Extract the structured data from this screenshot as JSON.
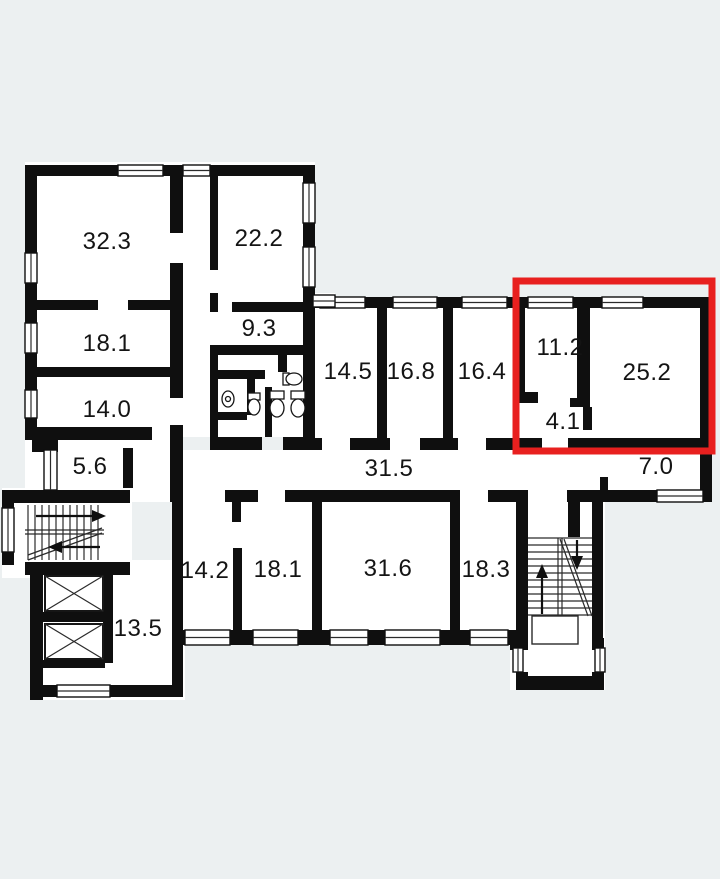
{
  "floorplan": {
    "type": "building-floor-plan",
    "background_color": "#ecf0f1",
    "wall_color": "#0f0f0f",
    "highlight_color": "#e8201f",
    "highlighted_room_areas": [
      "11.2",
      "4.1",
      "25.2"
    ],
    "rooms": [
      {
        "id": "room-32-3",
        "label": "32.3"
      },
      {
        "id": "room-22-2",
        "label": "22.2"
      },
      {
        "id": "room-18-1-upper",
        "label": "18.1"
      },
      {
        "id": "room-9-3",
        "label": "9.3"
      },
      {
        "id": "room-14-0",
        "label": "14.0"
      },
      {
        "id": "room-14-5",
        "label": "14.5"
      },
      {
        "id": "room-16-8",
        "label": "16.8"
      },
      {
        "id": "room-16-4",
        "label": "16.4"
      },
      {
        "id": "room-11-2",
        "label": "11.2"
      },
      {
        "id": "room-25-2",
        "label": "25.2"
      },
      {
        "id": "room-4-1",
        "label": "4.1"
      },
      {
        "id": "corridor-5-6",
        "label": "5.6"
      },
      {
        "id": "corridor-31-5",
        "label": "31.5"
      },
      {
        "id": "corridor-7-0",
        "label": "7.0"
      },
      {
        "id": "room-14-2",
        "label": "14.2"
      },
      {
        "id": "room-18-1-lower",
        "label": "18.1"
      },
      {
        "id": "room-31-6",
        "label": "31.6"
      },
      {
        "id": "room-18-3",
        "label": "18.3"
      },
      {
        "id": "room-13-5",
        "label": "13.5"
      }
    ]
  }
}
